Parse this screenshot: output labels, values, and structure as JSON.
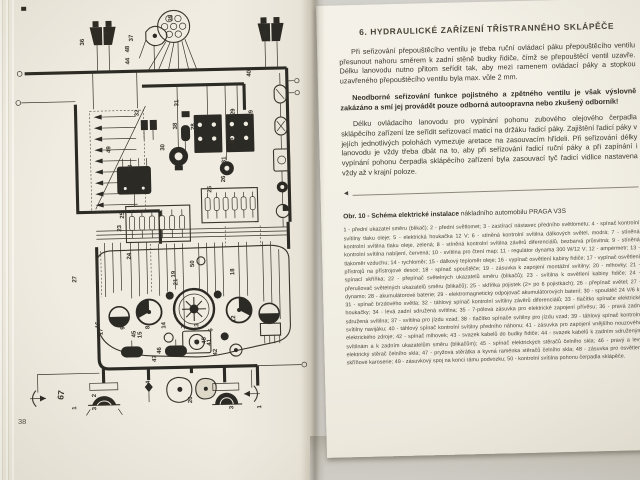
{
  "book": {
    "left_page": {
      "page_number": "38",
      "figure_side_label": "67",
      "diagram_labels": [
        {
          "t": "36",
          "x": 88,
          "y": 44
        },
        {
          "t": "4",
          "x": 112,
          "y": 34
        },
        {
          "t": "37",
          "x": 137,
          "y": 41
        },
        {
          "t": "48",
          "x": 133,
          "y": 52
        },
        {
          "t": "44",
          "x": 133,
          "y": 64
        },
        {
          "t": "35",
          "x": 177,
          "y": 22
        },
        {
          "t": "34",
          "x": 271,
          "y": 40
        },
        {
          "t": "40",
          "x": 254,
          "y": 79
        },
        {
          "t": "39",
          "x": 255,
          "y": 119
        },
        {
          "t": "29",
          "x": 237,
          "y": 117
        },
        {
          "t": "32",
          "x": 141,
          "y": 116
        },
        {
          "t": "31",
          "x": 181,
          "y": 107
        },
        {
          "t": "38",
          "x": 179,
          "y": 130
        },
        {
          "t": "30",
          "x": 166,
          "y": 151
        },
        {
          "t": "28",
          "x": 197,
          "y": 131
        },
        {
          "t": "28",
          "x": 235,
          "y": 146
        },
        {
          "t": "49",
          "x": 112,
          "y": 152
        },
        {
          "t": "43",
          "x": 133,
          "y": 171
        },
        {
          "t": "25",
          "x": 124,
          "y": 218
        },
        {
          "t": "25",
          "x": 212,
          "y": 194
        },
        {
          "t": "23",
          "x": 121,
          "y": 231
        },
        {
          "t": "26",
          "x": 226,
          "y": 184
        },
        {
          "t": "31",
          "x": 227,
          "y": 165
        },
        {
          "t": "27",
          "x": 75,
          "y": 281
        },
        {
          "t": "24",
          "x": 130,
          "y": 259
        },
        {
          "t": "19",
          "x": 174,
          "y": 278
        },
        {
          "t": "21",
          "x": 176,
          "y": 286
        },
        {
          "t": "50",
          "x": 193,
          "y": 268
        },
        {
          "t": "18",
          "x": 233,
          "y": 277
        },
        {
          "t": "16",
          "x": 97,
          "y": 327
        },
        {
          "t": "17",
          "x": 100,
          "y": 334
        },
        {
          "t": "9",
          "x": 122,
          "y": 329
        },
        {
          "t": "45",
          "x": 133,
          "y": 337
        },
        {
          "t": "15",
          "x": 139,
          "y": 338
        },
        {
          "t": "8",
          "x": 147,
          "y": 329
        },
        {
          "t": "14",
          "x": 163,
          "y": 329
        },
        {
          "t": "7",
          "x": 183,
          "y": 329
        },
        {
          "t": "13",
          "x": 196,
          "y": 331
        },
        {
          "t": "6",
          "x": 210,
          "y": 333
        },
        {
          "t": "12",
          "x": 233,
          "y": 324
        },
        {
          "t": "5",
          "x": 196,
          "y": 344
        },
        {
          "t": "45",
          "x": 203,
          "y": 345
        },
        {
          "t": "41",
          "x": 208,
          "y": 347
        },
        {
          "t": "47",
          "x": 153,
          "y": 362
        },
        {
          "t": "46",
          "x": 158,
          "y": 354
        },
        {
          "t": "42",
          "x": 214,
          "y": 357
        },
        {
          "t": "1",
          "x": 72,
          "y": 408
        },
        {
          "t": "2",
          "x": 92,
          "y": 396
        },
        {
          "t": "3",
          "x": 92,
          "y": 409
        },
        {
          "t": "4",
          "x": 146,
          "y": 384
        },
        {
          "t": "20",
          "x": 188,
          "y": 404
        },
        {
          "t": "2",
          "x": 228,
          "y": 399
        },
        {
          "t": "3",
          "x": 229,
          "y": 411
        },
        {
          "t": "1",
          "x": 257,
          "y": 411
        }
      ]
    },
    "right_page": {
      "chapter_title": "6. HYDRAULICKÉ ZAŘÍZENÍ TŘÍSTRANNÉHO SKLÁPĚČE",
      "para1": "Při seřizování přepouštěcího ventilu je třeba ruční ovládací páku přepouštěcího ventilu přesunout nahoru směrem k zadní stěně budky řidiče, čímž se přepouštěcí ventil uzavře. Délku lanovodu nutno přitom seřídit tak, aby mezi ramenem ovládací páky a stopkou uzavřeného přepouštěcího ventilu byla max. vůle 2 mm.",
      "para2": "Neodborné seřizování funkce pojistného a zpětného ventilu je však výslovně zakázáno a smí jej provádět pouze odborná autoopravna nebo zkušený odborník!",
      "para3": "Délku ovládacího lanovodu pro vypínání pohonu zubového olejového čerpadla sklápěcího zařízení lze seřídit seřizovací maticí na držáku řadicí páky. Zajištění řadicí páky v jejích jednotlivých polohách vymezuje aretace na zasouvacím hřídeli. Při seřizování délky lanovodu je vždy třeba dbát na to, aby při seřizování řadicí ruční páky a při zapínání i vypínání pohonu čerpadla sklápěcího zařízení byla zasouvací tyč řadicí vidlice nastavena vždy až v krajní poloze.",
      "pointer_icon": "◄",
      "caption_bold": "Obr. 10 - Schéma elektrické instalace",
      "caption_rest": " nákladního automobilu PRAGA V3S",
      "legend_items": [
        "1 - přední ukazatel směru (blikač)",
        "2 - přední světlomet",
        "3 - zastírací nástavec předního světlometu",
        "4 - spínač kontrolní svítilny tlaku oleje",
        "5 - elektrická houkačka 12 V",
        "6 - stíněná kontrolní svítilna dálkových světel, modrá",
        "7 - stíněná kontrolní svítilna tlaku oleje, zelená",
        "8 - stíněná kontrolní svítilna závěrů diferenciálů, bezbarvá průsvitná",
        "9 - stíněná kontrolní svítilna nabíjení, červená",
        "10 - svítilna pro čtení map",
        "11 - regulátor dynama 300 W/12 V",
        "12 - ampérmetr",
        "13 - tlakoměr vzduchu",
        "14 - rychloměr",
        "15 - dálkový teploměr oleje",
        "16 - vypínač osvětlení kabiny řidiče",
        "17 - vypínač osvětlení přístrojů na přístrojové desce",
        "18 - spínač spouštěče",
        "19 - zásuvka k zapojení montážní svítilny",
        "20 - mlhovky",
        "21 - spínací skříňka",
        "22 - přepínač světelných ukazatelů směru (blikačů)",
        "23 - svítilna k osvětlení kabiny řidiče",
        "24 - přerušovač světelných ukazatelů směru (blikačů)",
        "25 - skříňka pojistek (2× po 6 pojistkách)",
        "26 - přepínač světel",
        "27 - dynamo",
        "28 - akumulátorové baterie",
        "29 - elektromagnetický odpojovač akumulátorových baterií",
        "30 - spouštěč 24 V/6 k",
        "31 - spínač brzdového světla",
        "32 - táhlový spínač kontrolní svítilny závěrů diferenciálů",
        "33 - tlačítko spínače elektrické houkačky",
        "34 - levá zadní sdružená svítilna",
        "35 - 7-pólová zásuvka pro elektrické zapojení přívěsu",
        "36 - pravá zadní sdružená svítilna",
        "37 - svítilna pro jízdu vzad",
        "38 - tlačítko spínače svítilny pro jízdu vzad",
        "39 - táhlový spínač kontrolní svítilny navijáku",
        "40 - táhlový spínač kontrolní svítilny předního náhonu",
        "41 - zásuvka pro zapojení vnějšího nouzového elektrického zdroje",
        "42 - spínač mlhovek",
        "43 - svazek kabelů do budky řidiče",
        "44 - svazek kabelů k zadním sdruženým svítilnám a k zadním ukazatelům směru (blikačům)",
        "45 - spínač elektrických stěračů čelního skla",
        "46 - pravý a levý elektrický stěrač čelního skla",
        "47 - pryžová stěrátka a kyvná raménka stěračů čelního skla",
        "48 - zásuvka pro osvětlení skříňové karoserie",
        "49 - zásuvkový spoj na konci rámu podvozku",
        "50 - kontrolní svítilna pohonu čerpadla sklápěče."
      ],
      "page_number": "3"
    }
  }
}
